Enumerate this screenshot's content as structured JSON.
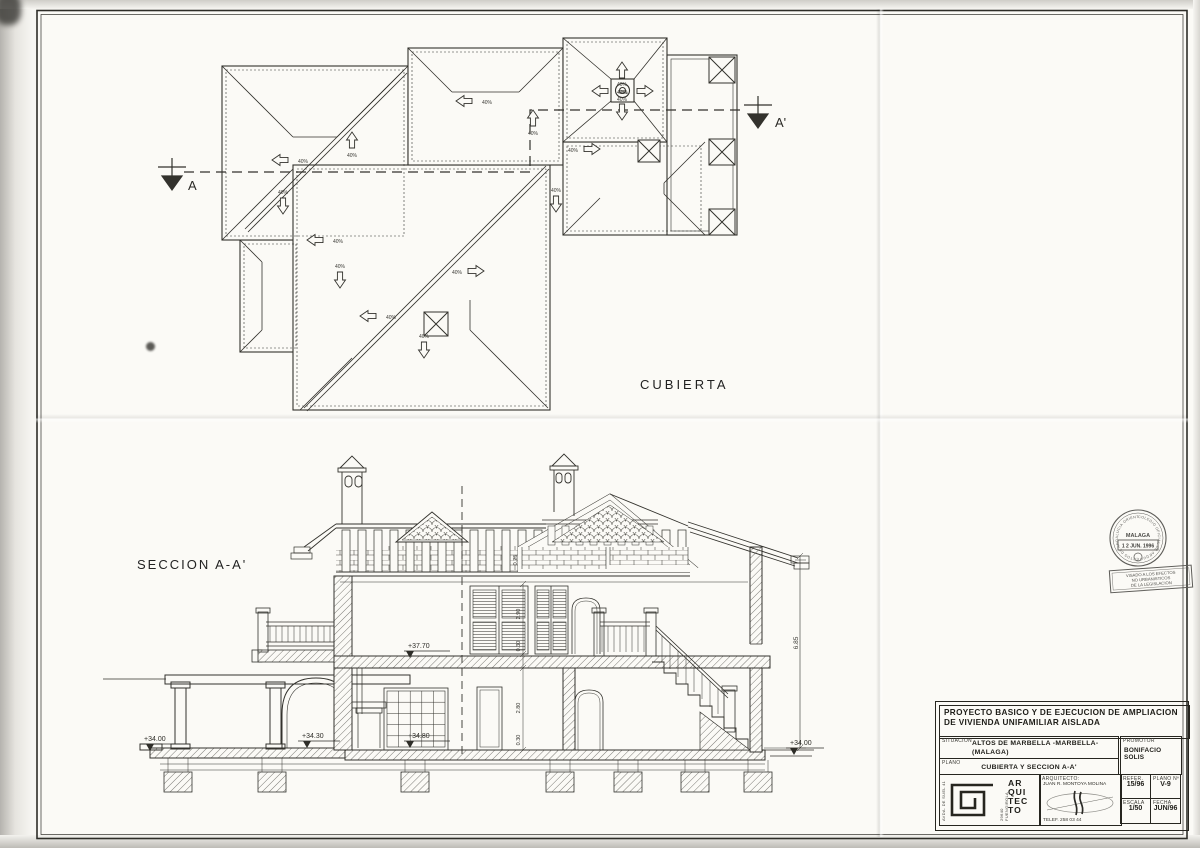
{
  "roof_plan": {
    "title": "CUBIERTA",
    "slope_label": "40%",
    "marker_a": "A",
    "marker_a_prime": "A'"
  },
  "section": {
    "title": "SECCION A-A'",
    "levels": {
      "left_ground": "+34.00",
      "porch": "+34.30",
      "ground_floor": "+34.80",
      "upper_floor": "+37.70",
      "right_ground": "+34.00"
    },
    "dimensions": {
      "total_height": "6.85",
      "upper_room": "2.90",
      "upper_slab": "0.30",
      "lower_room": "2.80",
      "lower_slab": "0.30",
      "rafter": "0.25"
    }
  },
  "stamps": {
    "college_ring": "COLEGIO OFICIAL DE ARQUITECTOS DE ANDALUCIA ORIENTAL",
    "college_city": "MALAGA",
    "visa_date": "1 2 JUN. 1996",
    "visa_line1": "VISADO A LOS EFECTOS",
    "visa_line2": "NO URBANISTICOS",
    "visa_line3": "DE LA LEGISLACION"
  },
  "title_block": {
    "project_title_line1": "PROYECTO BASICO Y DE EJECUCION DE AMPLIACION",
    "project_title_line2": "DE VIVIENDA UNIFAMILIAR AISLADA",
    "situacion_label": "SITUACION",
    "situacion_line1": "ALTOS DE MARBELLA -MARBELLA-",
    "situacion_line2": "(MALAGA)",
    "promotor_label": "PROMOTOR",
    "promotor_value": "BONIFACIO SOLIS",
    "plano_label": "PLANO",
    "plano_value": "CUBIERTA Y SECCION A-A'",
    "arquitecto_label": "ARQUITECTO:",
    "arquitecto_name": "JUAN R. MONTOYA MOLINA",
    "telefono": "TELEF. 258 03 44",
    "logo_word": [
      "AR",
      "QUI",
      "TEC",
      "TO"
    ],
    "address_vertical": "AVDA. DE SUEL 41",
    "city_vertical": "29640 FUENGIROLA",
    "refer_label": "REFER.",
    "refer_value": "15/96",
    "plano_num_label": "PLANO Nº",
    "plano_num_value": "V-9",
    "escala_label": "ESCALA",
    "escala_value": "1/50",
    "fecha_label": "FECHA",
    "fecha_value": "JUN/96"
  }
}
